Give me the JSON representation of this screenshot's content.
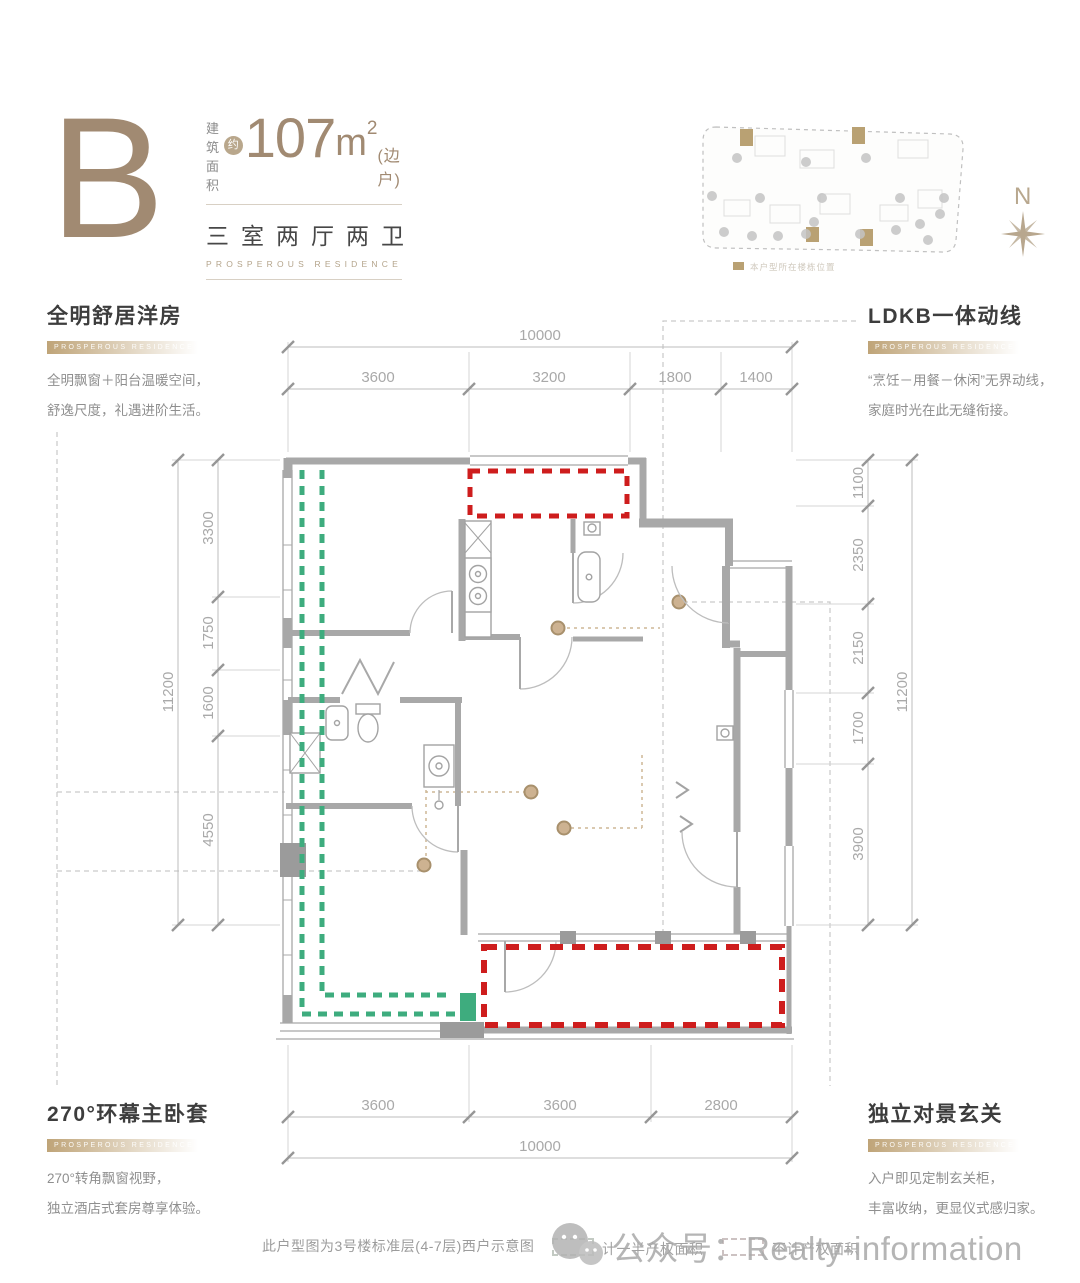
{
  "header": {
    "unit": "B",
    "area_label_1": "建筑",
    "area_label_2": "面积",
    "approx": "约",
    "area_value": "107",
    "area_unit": "m",
    "area_sup": "2",
    "area_note": "(边户)",
    "rooms": "三室两厅两卫",
    "tagline": "PROSPEROUS RESIDENCE"
  },
  "features": {
    "top_left": {
      "title": "全明舒居洋房",
      "ribbon": "PROSPEROUS RESIDENCE",
      "line1": "全明飘窗＋阳台温暖空间，",
      "line2": "舒逸尺度，礼遇进阶生活。"
    },
    "top_right": {
      "title": "LDKB一体动线",
      "ribbon": "PROSPEROUS RESIDENCE",
      "line1": "“烹饪－用餐－休闲”无界动线，",
      "line2": "家庭时光在此无缝衔接。"
    },
    "bottom_left": {
      "title": "270°环幕主卧套",
      "ribbon": "PROSPEROUS RESIDENCE",
      "line1": "270°转角飘窗视野，",
      "line2": "独立酒店式套房尊享体验。"
    },
    "bottom_right": {
      "title": "独立对景玄关",
      "ribbon": "PROSPEROUS RESIDENCE",
      "line1": "入户即见定制玄关柜，",
      "line2": "丰富收纳，更显仪式感归家。"
    }
  },
  "site_plan": {
    "north": "N",
    "legend": "本户型所在楼栋位置"
  },
  "dims": {
    "top": {
      "total": "10000",
      "segments": [
        "3600",
        "3200",
        "1800",
        "1400"
      ]
    },
    "bottom": {
      "total": "10000",
      "segments": [
        "3600",
        "3600",
        "2800"
      ]
    },
    "left": {
      "total": "11200",
      "segments": [
        "3300",
        "1750",
        "1600",
        "4550"
      ]
    },
    "right": {
      "total": "11200",
      "segments": [
        "1100",
        "2350",
        "2150",
        "1700",
        "3900"
      ]
    }
  },
  "footer": {
    "caption": "此户型图为3号楼标准层(4-7层)西户示意图",
    "legend_half": "计一半产权面积",
    "legend_none": "不计产权面积"
  },
  "watermark": {
    "text": "公众号：Realty-information"
  },
  "colors": {
    "accent": "#a18a72",
    "green": "#3eac7e",
    "red": "#ce1d1d",
    "wall": "#a8a8a8",
    "dim_text": "#a9a9a9"
  }
}
